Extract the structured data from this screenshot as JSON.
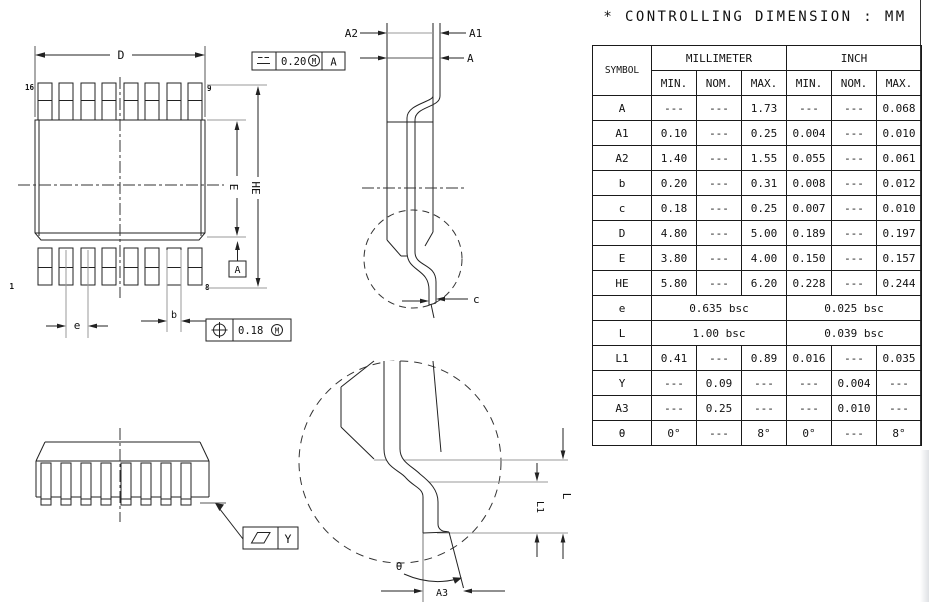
{
  "title": "* CONTROLLING DIMENSION : MM",
  "table": {
    "symbol_header": "SYMBOL",
    "unit_headers": [
      "MILLIMETER",
      "INCH"
    ],
    "limit_headers": [
      "MIN.",
      "NOM.",
      "MAX.",
      "MIN.",
      "NOM.",
      "MAX."
    ],
    "rows": [
      {
        "symbol": "A",
        "cells": [
          "---",
          "---",
          "1.73",
          "---",
          "---",
          "0.068"
        ]
      },
      {
        "symbol": "A1",
        "cells": [
          "0.10",
          "---",
          "0.25",
          "0.004",
          "---",
          "0.010"
        ]
      },
      {
        "symbol": "A2",
        "cells": [
          "1.40",
          "---",
          "1.55",
          "0.055",
          "---",
          "0.061"
        ]
      },
      {
        "symbol": "b",
        "cells": [
          "0.20",
          "---",
          "0.31",
          "0.008",
          "---",
          "0.012"
        ]
      },
      {
        "symbol": "c",
        "cells": [
          "0.18",
          "---",
          "0.25",
          "0.007",
          "---",
          "0.010"
        ]
      },
      {
        "symbol": "D",
        "cells": [
          "4.80",
          "---",
          "5.00",
          "0.189",
          "---",
          "0.197"
        ]
      },
      {
        "symbol": "E",
        "cells": [
          "3.80",
          "---",
          "4.00",
          "0.150",
          "---",
          "0.157"
        ]
      },
      {
        "symbol": "HE",
        "cells": [
          "5.80",
          "---",
          "6.20",
          "0.228",
          "---",
          "0.244"
        ]
      },
      {
        "symbol": "e",
        "span": true,
        "mm": "0.635 bsc",
        "inch": "0.025 bsc"
      },
      {
        "symbol": "L",
        "span": true,
        "mm": "1.00 bsc",
        "inch": "0.039 bsc"
      },
      {
        "symbol": "L1",
        "cells": [
          "0.41",
          "---",
          "0.89",
          "0.016",
          "---",
          "0.035"
        ]
      },
      {
        "symbol": "Y",
        "cells": [
          "---",
          "0.09",
          "---",
          "---",
          "0.004",
          "---"
        ]
      },
      {
        "symbol": "A3",
        "cells": [
          "---",
          "0.25",
          "---",
          "---",
          "0.010",
          "---"
        ]
      },
      {
        "symbol": "θ",
        "cells": [
          "0°",
          "---",
          "8°",
          "0°",
          "---",
          "8°"
        ]
      }
    ]
  },
  "drawing": {
    "top_view": {
      "dim_d": "D",
      "dim_e": "E",
      "dim_he": "HE",
      "dim_pitch": "e",
      "dim_b": "b",
      "pin_16": "16",
      "pin_9": "9",
      "pin_1": "1",
      "pin_8": "8",
      "datum_a": "A",
      "fcf_tolerance": "0.20",
      "fcf_modifier": "M",
      "fcf_datum": "A",
      "fcf_position_tolerance": "0.18",
      "fcf_position_modifier": "M"
    },
    "side_view": {
      "dim_a2": "A2",
      "dim_a1": "A1",
      "dim_a": "A",
      "dim_c": "c"
    },
    "front_view": {
      "fcf_flatness_ref": "Y"
    },
    "detail_view": {
      "dim_l1": "L1",
      "dim_l": "L",
      "dim_theta": "θ",
      "dim_a3": "A3"
    }
  }
}
